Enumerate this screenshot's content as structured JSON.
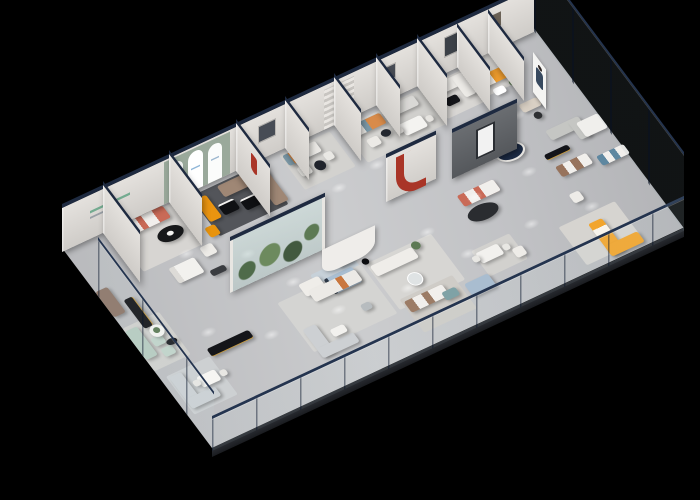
{
  "scene": {
    "alt": "3D isometric cutaway rendering of a furniture showroom floor plan on a black background",
    "background": "#000000",
    "render_style": "photorealistic isometric cutaway, glass perimeter walls, navy-capped white partitions",
    "arch_window_count": 3,
    "ceiling_spotlights": 20
  },
  "palette": {
    "floor": "#c3c4c7",
    "wall": "#e4e1dd",
    "wall-side": "#cfccc8",
    "cap": "#1e2a40",
    "slab": "#24262b",
    "accent-orange": "#ef9d2e",
    "accent-orange-deep": "#e8930c",
    "accent-coral": "#c96a57",
    "accent-red": "#a93527",
    "sage": "#b7cbc0",
    "sage-wall": "#9aa99b",
    "steel-blue": "#7b98a6",
    "teal": "#7fa2a6",
    "light-blue": "#aabfd2",
    "brown": "#9f8775",
    "leather": "#9c7c66",
    "dark-brown": "#8d7668",
    "black-gloss": "#141519",
    "gold": "#c79a3d",
    "dark-feature-wall": "#64676b",
    "rug-dark": "#53555a",
    "white-fabric": "#eceae6",
    "plant-green": "#5d7a54"
  },
  "rooms": [
    {
      "label": "coral sofa lounge"
    },
    {
      "label": "arched display room with brown sectional"
    },
    {
      "label": "steel-blue sofa vignette"
    },
    {
      "label": "steel-blue sofa vignette 2"
    },
    {
      "label": "dining display"
    },
    {
      "label": "white sectional vignette"
    },
    {
      "label": "orange sofa corner room"
    },
    {
      "label": "indoor cactus terrarium"
    },
    {
      "label": "bedroom pod display"
    },
    {
      "label": "central white sofa lounge"
    },
    {
      "label": "sage green lounge"
    },
    {
      "label": "grey sofa and dining corner"
    },
    {
      "label": "dark feature wall lounge"
    },
    {
      "label": "leather sofa and dining"
    },
    {
      "label": "yellow sectional display"
    },
    {
      "label": "glass-walled right wing"
    }
  ],
  "signage": {
    "wall_sign": "green striped wall sign",
    "arch_logo": "small blue logo on arch window",
    "red_emblem": "red emblem slot",
    "red_sculpture": "red J-shaped wall sculpture",
    "standee": "person standee poster"
  }
}
